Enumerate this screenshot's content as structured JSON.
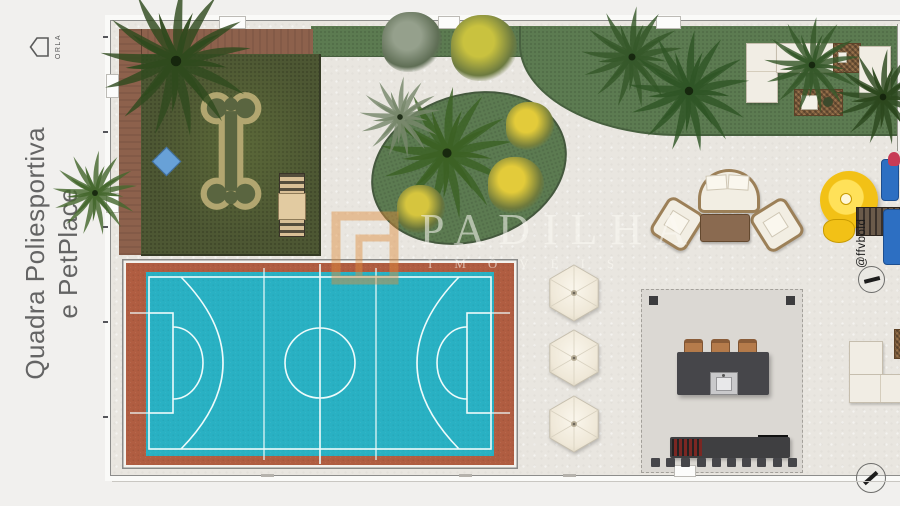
{
  "title": {
    "line1": "Quadra Poliesportiva",
    "line2": "e PetPlace"
  },
  "orla": {
    "label": "ORLA"
  },
  "watermark": {
    "brand": "PADILHA",
    "subtitle": "IMÓVEIS"
  },
  "credit": "@ffvbold",
  "colors": {
    "bg_outer": "#f1f0ee",
    "concrete": "#e9e6e0",
    "lawn_green": "#5c7b51",
    "pet_lawn": "#4d5733",
    "deck_brown": "#8d614c",
    "court_red": "#b05d41",
    "court_blue": "#29b1c3",
    "court_line": "#eefbfb",
    "bone_path": "#b2a670",
    "bone_inner": "#5a6540",
    "pet_mat_blue": "#68a1d7",
    "umbrella": "#f0e9da",
    "kiosk_slab": "#dbd8d3",
    "counter_dark": "#46464a",
    "stool_brown": "#b57b4b",
    "table_brown": "#8a6a50",
    "sofa_white": "#f1ede4",
    "slide_yellow": "#f2c116",
    "play_blue": "#2d6fc2",
    "play_red": "#c73b55",
    "watermark_orange": "#e08c3c",
    "label_gray": "#646464"
  }
}
